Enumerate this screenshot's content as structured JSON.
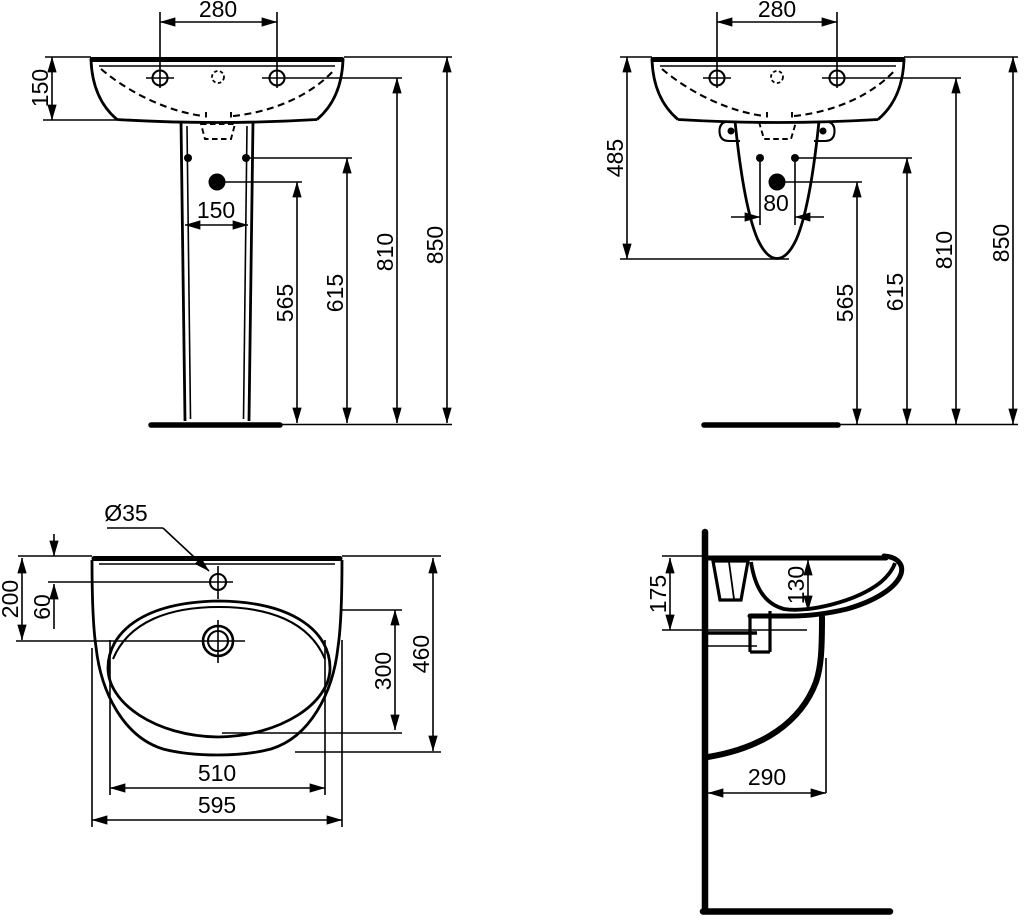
{
  "drawing": {
    "type": "technical-dimension-drawing",
    "subject": "pedestal washbasin, four orthographic views",
    "units": "mm",
    "colors": {
      "line": "#000000",
      "background": "#ffffff"
    },
    "views": {
      "front_pedestal": {
        "name": "front view with full pedestal",
        "dims": {
          "tap_hole_centres": "280",
          "rim_to_basin_underside": "150",
          "pedestal_fixing_width": "150",
          "trap_outlet_height": "565",
          "fixing_hole_height": "615",
          "tap_hole_height": "810",
          "rim_height": "850"
        }
      },
      "front_semi_pedestal": {
        "name": "front view with semi-pedestal",
        "dims": {
          "tap_hole_centres": "280",
          "semi_pedestal_height": "485",
          "fixing_hole_centres": "80",
          "trap_outlet_height": "565",
          "fixing_hole_height": "615",
          "tap_hole_height": "810",
          "rim_height": "850"
        }
      },
      "plan": {
        "name": "plan view (top)",
        "dims": {
          "tap_hole_diameter": "Ø35",
          "rim_to_tap_centre": "60",
          "rim_to_drain_centre": "200",
          "bowl_depth": "300",
          "overall_depth": "460",
          "bowl_width": "510",
          "overall_width": "595"
        }
      },
      "side": {
        "name": "side section view",
        "dims": {
          "front_apron_height": "175",
          "bowl_inner_depth": "130",
          "wall_to_shroud_front": "290"
        }
      }
    }
  }
}
